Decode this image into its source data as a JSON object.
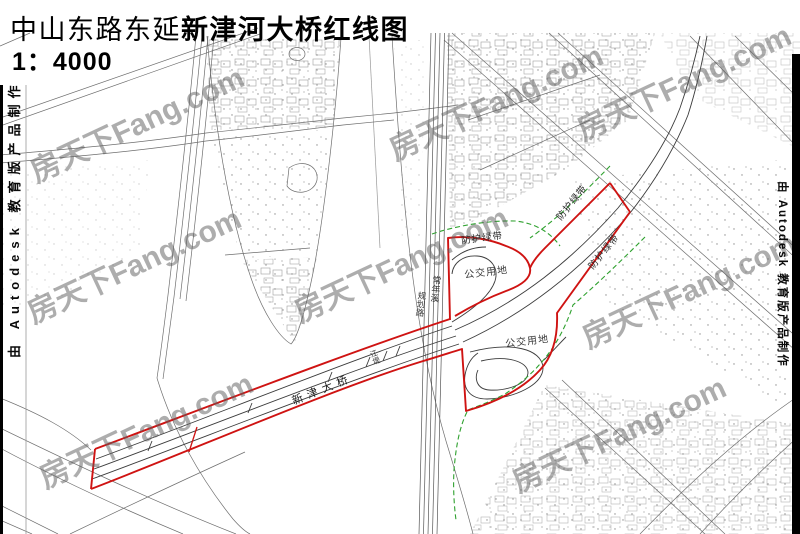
{
  "title": {
    "prefix": "中山东路东延",
    "emphasis": "新津河大桥红线图",
    "scale": "1：4000"
  },
  "plotstamp": {
    "text": "由 Autodesk 教育版产品制作"
  },
  "watermark": {
    "text": "房天下Fang.com",
    "rotation": -25,
    "color": "rgba(92,92,92,0.5)",
    "positions": [
      {
        "x": 136,
        "y": 122
      },
      {
        "x": 495,
        "y": 100
      },
      {
        "x": 683,
        "y": 80
      },
      {
        "x": 133,
        "y": 263
      },
      {
        "x": 400,
        "y": 262
      },
      {
        "x": 688,
        "y": 288
      },
      {
        "x": 145,
        "y": 428
      },
      {
        "x": 618,
        "y": 432
      }
    ]
  },
  "map_labels": [
    {
      "name": "bridge-name-label",
      "text": "新津大桥",
      "x": 322,
      "y": 389,
      "rot": -22,
      "size": 11,
      "ls": 5,
      "color": "#1a1a1a",
      "vertical": false
    },
    {
      "name": "green-belt-label-west",
      "text": "防护绿带",
      "x": 482,
      "y": 237,
      "rot": -7,
      "size": 9.5,
      "ls": 1,
      "color": "#2b2b2b",
      "vertical": false
    },
    {
      "name": "green-belt-label-north",
      "text": "防护绿带",
      "x": 571,
      "y": 202,
      "rot": -51,
      "size": 9.5,
      "ls": 1,
      "color": "#2b2b2b",
      "vertical": false
    },
    {
      "name": "green-belt-label-east",
      "text": "防护绿带",
      "x": 603,
      "y": 251,
      "rot": -51,
      "size": 9.5,
      "ls": 1,
      "color": "#2b2b2b",
      "vertical": false
    },
    {
      "name": "bus-land-label-north",
      "text": "公交用地",
      "x": 486,
      "y": 271,
      "rot": -7,
      "size": 10,
      "ls": 1,
      "color": "#3a3a3a",
      "vertical": false
    },
    {
      "name": "bus-land-label-south",
      "text": "公交用地",
      "x": 527,
      "y": 340,
      "rot": -7,
      "size": 10,
      "ls": 1,
      "color": "#3a3a3a",
      "vertical": false
    },
    {
      "name": "stream-label",
      "text": "常年溪",
      "x": 436,
      "y": 289,
      "rot": 6,
      "size": 9,
      "ls": 0,
      "color": "#333333",
      "vertical": true
    },
    {
      "name": "road-label-vertical",
      "text": "规划路",
      "x": 421,
      "y": 304,
      "rot": 6,
      "size": 8.5,
      "ls": 0,
      "color": "#333333",
      "vertical": true
    },
    {
      "name": "dike-label",
      "text": "江堤",
      "x": 375,
      "y": 357,
      "rot": -20,
      "size": 7.5,
      "ls": 0,
      "color": "#333333",
      "vertical": true
    }
  ],
  "colors": {
    "red_line": "#cf1312",
    "green_belt": "#2fa12f",
    "linework": "#6e6e6e"
  }
}
